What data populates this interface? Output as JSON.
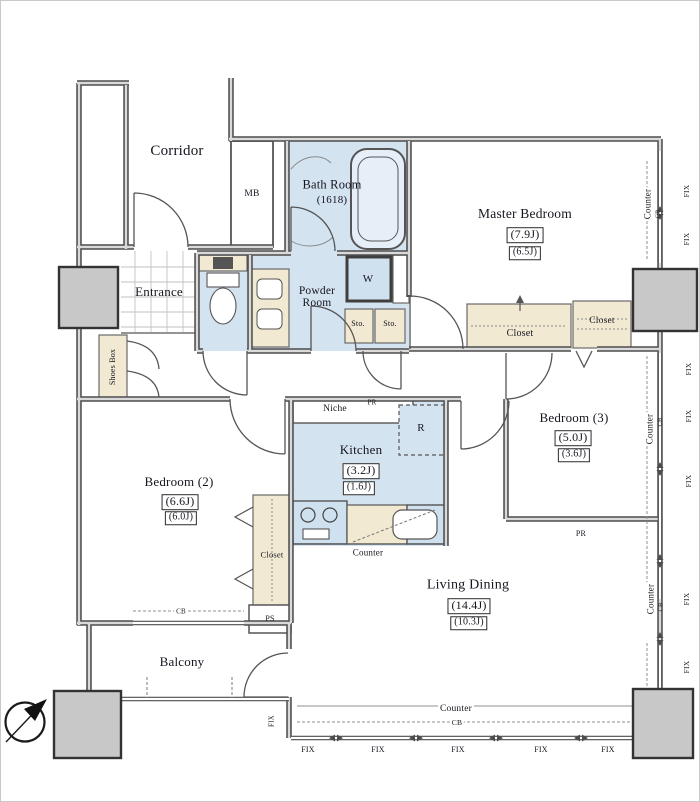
{
  "floorplan": {
    "labels": {
      "corridor": "Corridor",
      "mb": "MB",
      "bath": "Bath Room",
      "bath_size": "(1618)",
      "master": "Master Bedroom",
      "master_size1": "(7.9J)",
      "master_size2": "(6.5J)",
      "entrance": "Entrance",
      "shoes_box": "Shoes Box",
      "powder_room": "Powder Room",
      "washer": "W",
      "sto": "Sto.",
      "closet": "Closet",
      "niche": "Niche",
      "pr": "PR",
      "r": "R",
      "ps": "PS",
      "kitchen": "Kitchen",
      "kitchen_size1": "(3.2J)",
      "kitchen_size2": "(1.6J)",
      "bedroom2": "Bedroom (2)",
      "bedroom2_size1": "(6.6J)",
      "bedroom2_size2": "(6.0J)",
      "bedroom3": "Bedroom (3)",
      "bedroom3_size1": "(5.0J)",
      "bedroom3_size2": "(3.6J)",
      "living": "Living Dining",
      "living_size1": "(14.4J)",
      "living_size2": "(10.3J)",
      "balcony": "Balcony",
      "counter": "Counter",
      "cb": "CB",
      "fix": "FIX"
    },
    "colors": {
      "wet_area": "#d4e3f0",
      "storage": "#f1e9d2",
      "wall_dark": "#4d4d4d",
      "wall_light": "#dadada",
      "pillar": "#c8c8c8"
    }
  }
}
